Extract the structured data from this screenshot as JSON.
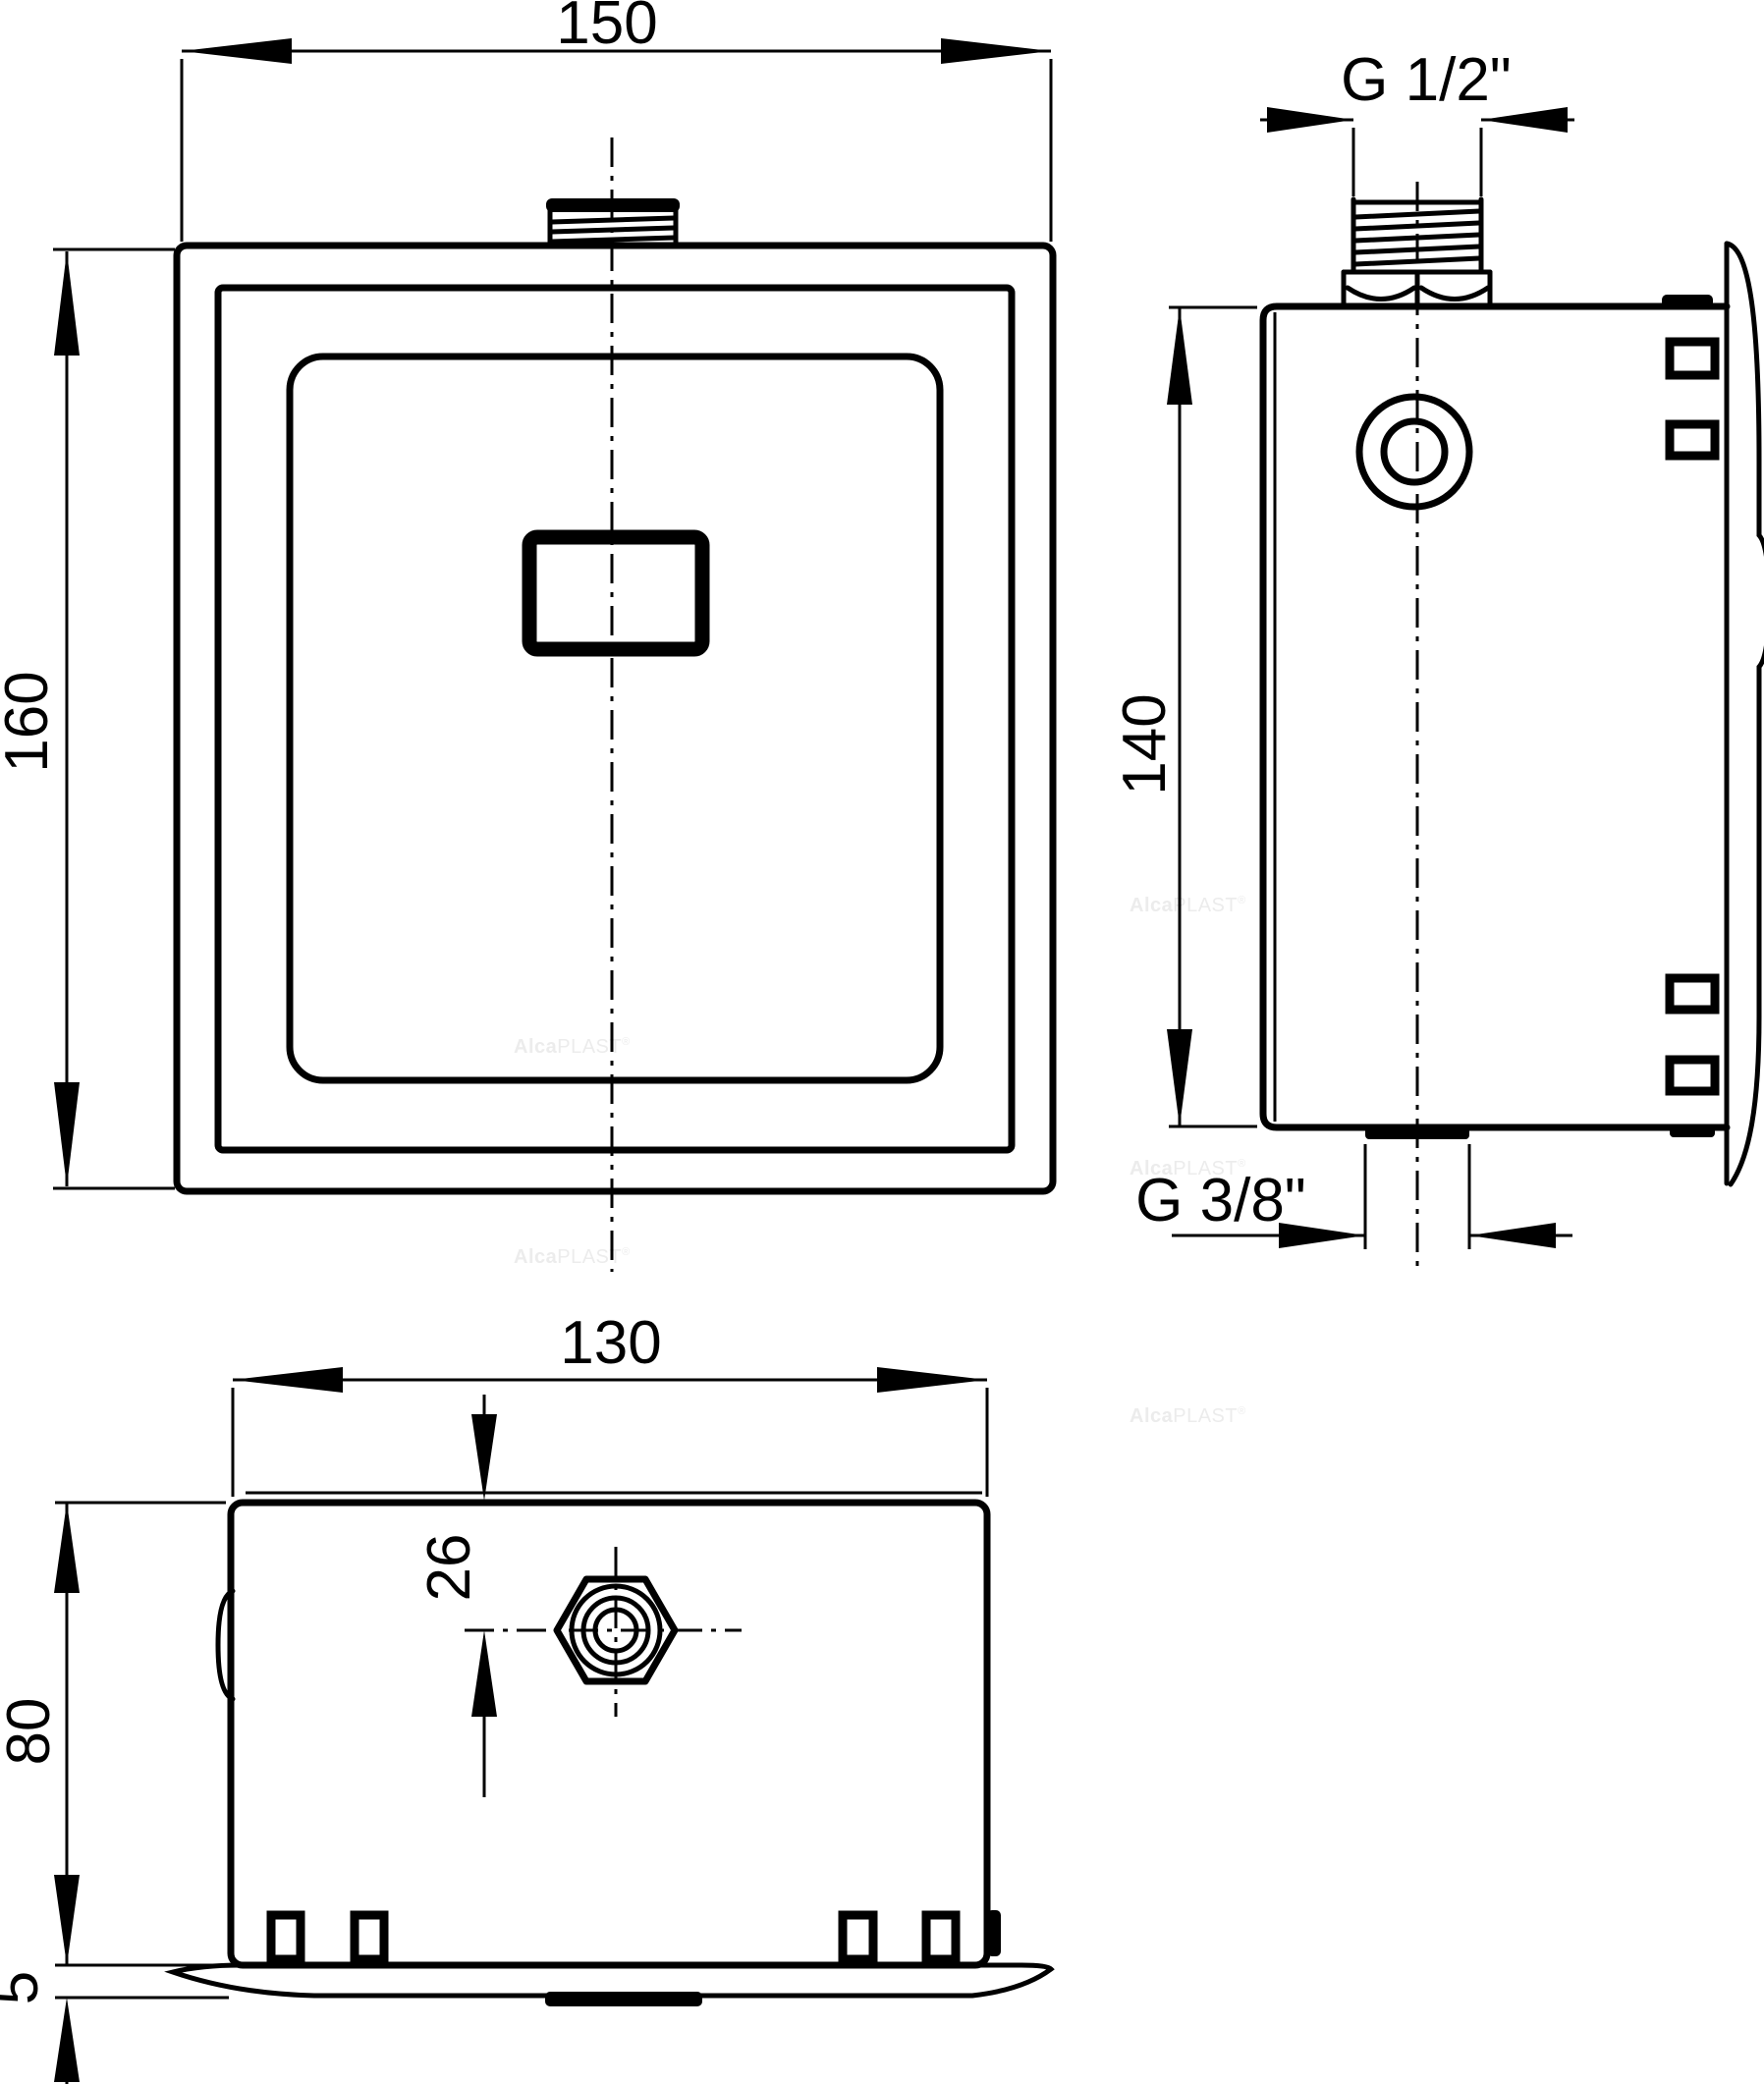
{
  "drawing": {
    "type": "technical-dimension-drawing",
    "views": {
      "front": "front view of flush sensor plate",
      "side": "side section view with wall flange",
      "plan": "top view of recessed box"
    },
    "dims": {
      "front_width": "150",
      "front_height": "160",
      "top_thread": "G 1/2\"",
      "side_height": "140",
      "bottom_thread": "G 3/8\"",
      "plan_width": "130",
      "plan_center_offset": "26",
      "plan_depth": "80",
      "plan_flange_thickness": "5"
    },
    "watermark": {
      "alca": "Alca",
      "plast": "PLAST",
      "reg": "®"
    },
    "colors": {
      "line": "#000000",
      "background": "#ffffff",
      "watermark": "#ececec"
    }
  }
}
